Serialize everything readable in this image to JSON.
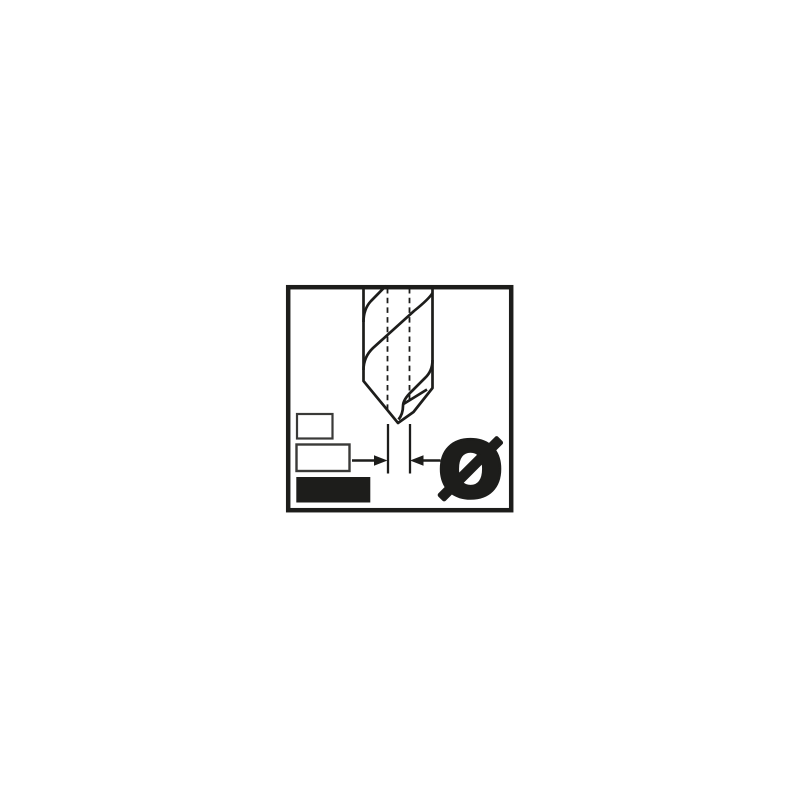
{
  "canvas": {
    "background": "#ffffff"
  },
  "pictogram": {
    "title": "drill-bit-diameter-pictogram",
    "ink_color": "#1d1d1b",
    "square_stroke_color": "#3a3a38",
    "diameter_symbol": "Ø",
    "size_squares": [
      {
        "id": "small",
        "filled": false
      },
      {
        "id": "medium",
        "filled": false
      },
      {
        "id": "large",
        "filled": true
      }
    ]
  }
}
